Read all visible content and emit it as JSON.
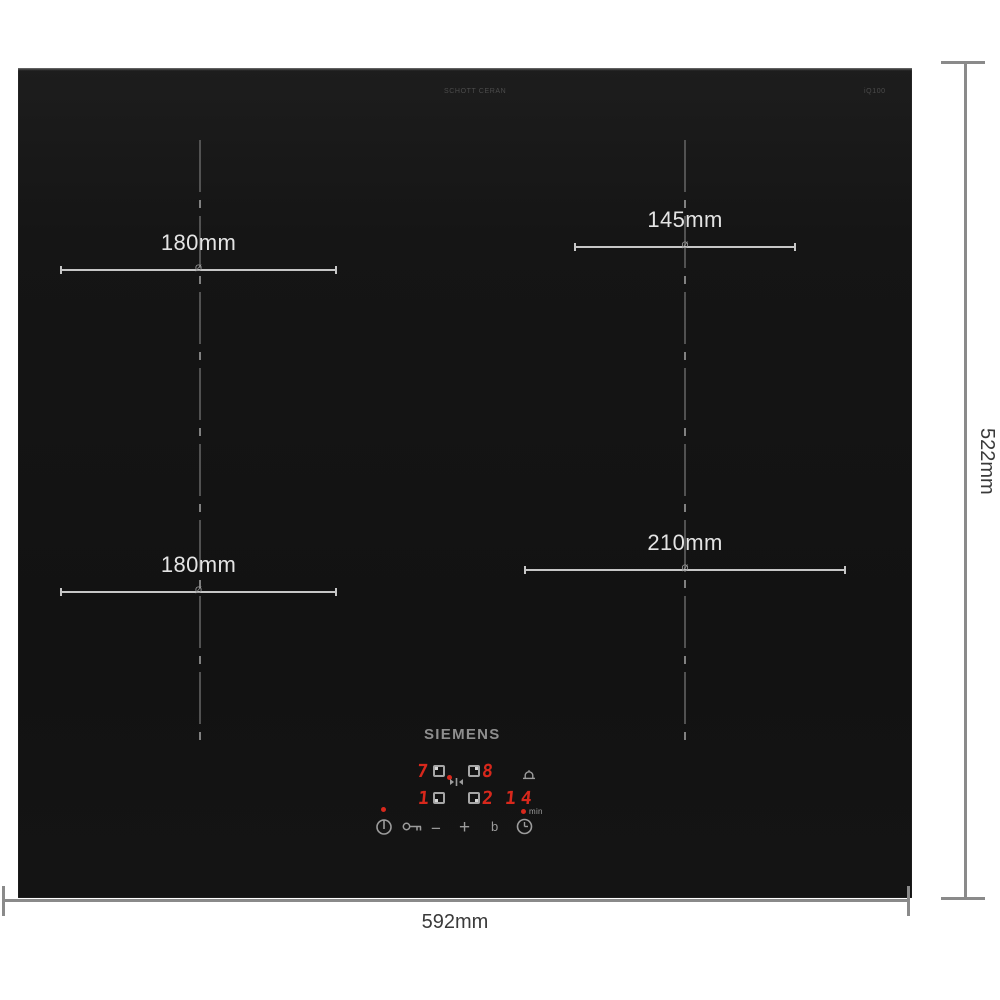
{
  "product": {
    "brand": "SIEMENS",
    "glass_print_center": "SCHOTT CERAN",
    "glass_print_right": "iQ100"
  },
  "dimensions": {
    "overall_width": "592mm",
    "overall_height": "522mm"
  },
  "zones": {
    "diameter_symbol": "Ø",
    "back_left": {
      "label": "180mm"
    },
    "back_right": {
      "label": "145mm"
    },
    "front_left": {
      "label": "180mm"
    },
    "front_right": {
      "label": "210mm"
    }
  },
  "control_panel": {
    "power_levels": {
      "back_left": "7",
      "back_right": "8",
      "front_left": "1",
      "front_right": "2"
    },
    "timer": {
      "value": "14",
      "unit": "min"
    },
    "buttons": {
      "minus": "−",
      "plus": "+",
      "boost": "b"
    },
    "colors": {
      "display_red": "#d8281c",
      "icon_gray": "#9c9c9c"
    }
  }
}
